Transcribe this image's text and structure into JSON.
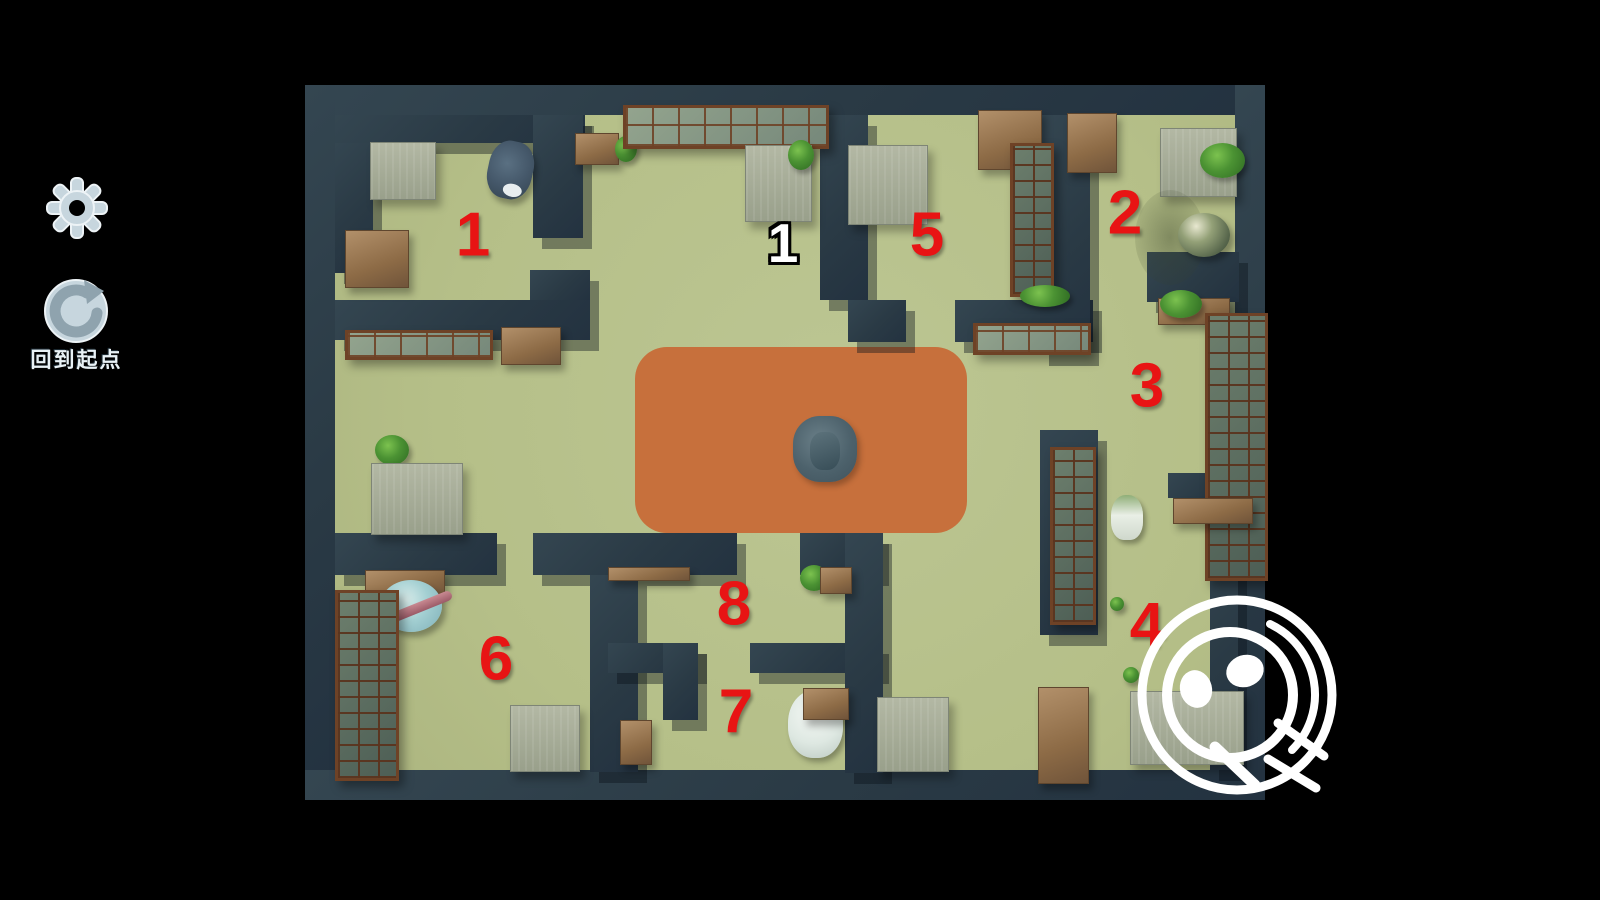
{
  "app": {
    "type": "hidden-object-floorplan-game",
    "background_color": "#000000"
  },
  "sidebar": {
    "settings_button": {
      "icon": "gear-icon"
    },
    "reset_button": {
      "icon": "circular-arrow-icon",
      "label": "回到起点"
    }
  },
  "map": {
    "floor_color": "#b7c18b",
    "wall_color": "#2c3c48",
    "rug_color": "#c7703c",
    "marker_red": "#e81414",
    "marker_white": "#ffffff",
    "room_markers": [
      {
        "label": "1"
      },
      {
        "label": "2"
      },
      {
        "label": "3"
      },
      {
        "label": "4"
      },
      {
        "label": "5"
      },
      {
        "label": "6"
      },
      {
        "label": "7"
      },
      {
        "label": "8"
      }
    ],
    "entrance_marker": {
      "label": "1"
    }
  },
  "find_button": {
    "icon": "magnifier-face-icon"
  }
}
